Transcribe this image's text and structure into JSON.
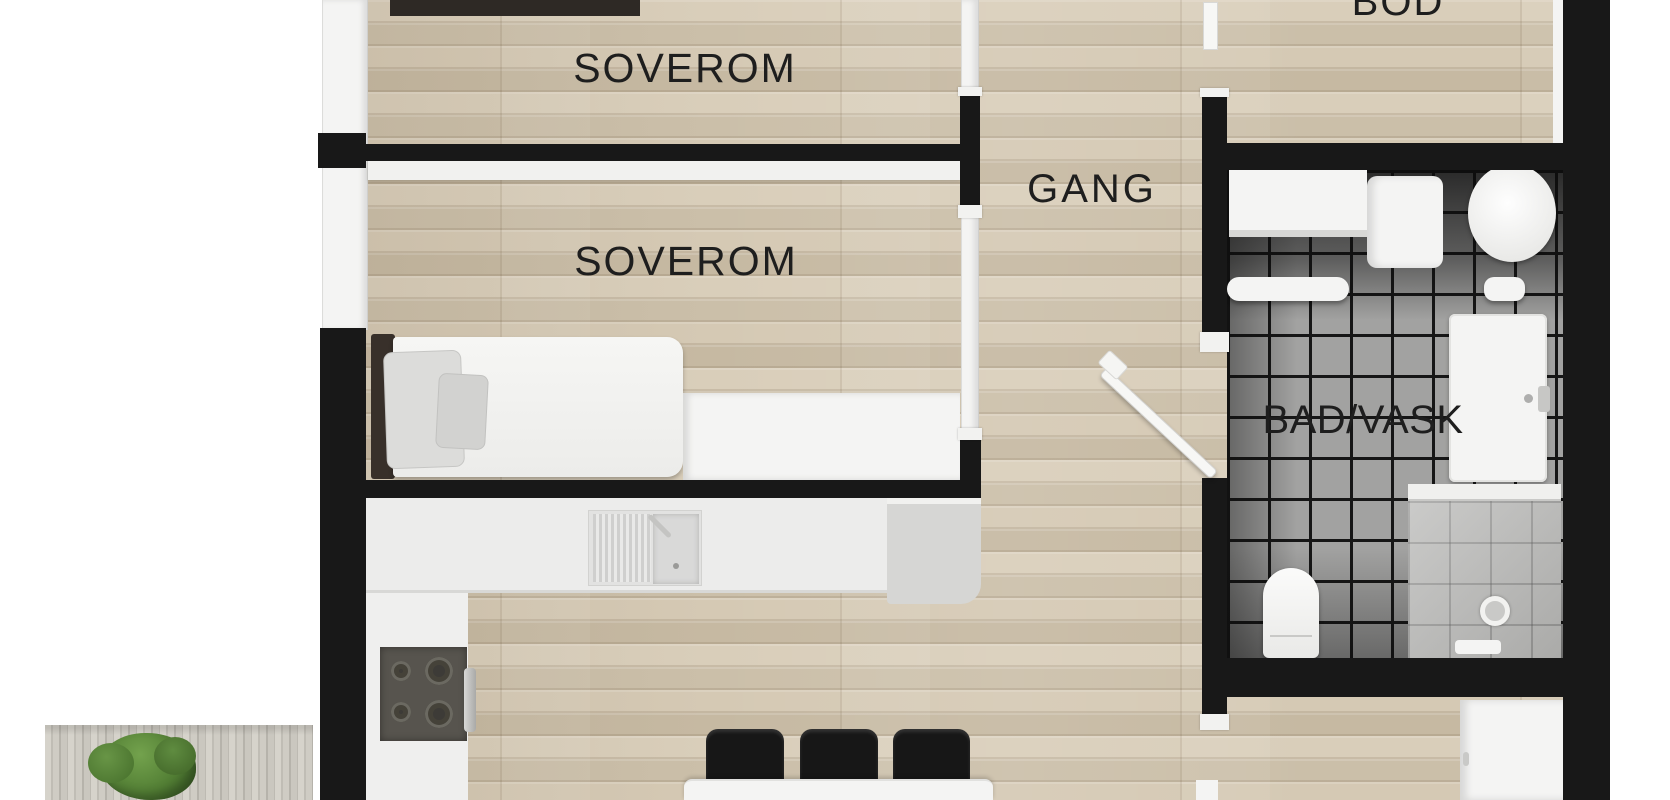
{
  "meta": {
    "title": "3D floor plan – apartment top-down render",
    "language": "Norwegian"
  },
  "rooms": [
    {
      "id": "soverom-1",
      "label": "SOVEROM"
    },
    {
      "id": "soverom-2",
      "label": "SOVEROM"
    },
    {
      "id": "gang",
      "label": "GANG"
    },
    {
      "id": "bod",
      "label": "BOD"
    },
    {
      "id": "bad-vask",
      "label": "BAD/VASK"
    }
  ],
  "furniture": {
    "soverom_2": [
      "single-bed",
      "headboard",
      "pillows",
      "sideboard-desk"
    ],
    "kitchen": [
      "l-shaped-counter",
      "sink-with-drainboard",
      "cooktop-stove",
      "oven-handle",
      "end-cabinet"
    ],
    "dining": [
      "white-table",
      "black-chair",
      "black-chair",
      "black-chair"
    ],
    "bad_vask": [
      "washer-unit",
      "laundry-box",
      "round-basin",
      "wall-shelf",
      "vanity-sink",
      "toilet",
      "shower-with-drain",
      "open-door"
    ],
    "outdoor": [
      "wood-deck",
      "green-plant"
    ]
  },
  "colors": {
    "wall_black": "#181818",
    "wall_white": "#f4f4f3",
    "floor_wood": "#d2c6b1",
    "deck_wood": "#c9c6be",
    "tile_gray": "#a2a2a1",
    "tile_grout": "#161616",
    "fixture_white": "#f4f4f3",
    "stove_gray": "#57544e",
    "plant_green": "#567f35",
    "label_text": "#1e1e1e"
  }
}
